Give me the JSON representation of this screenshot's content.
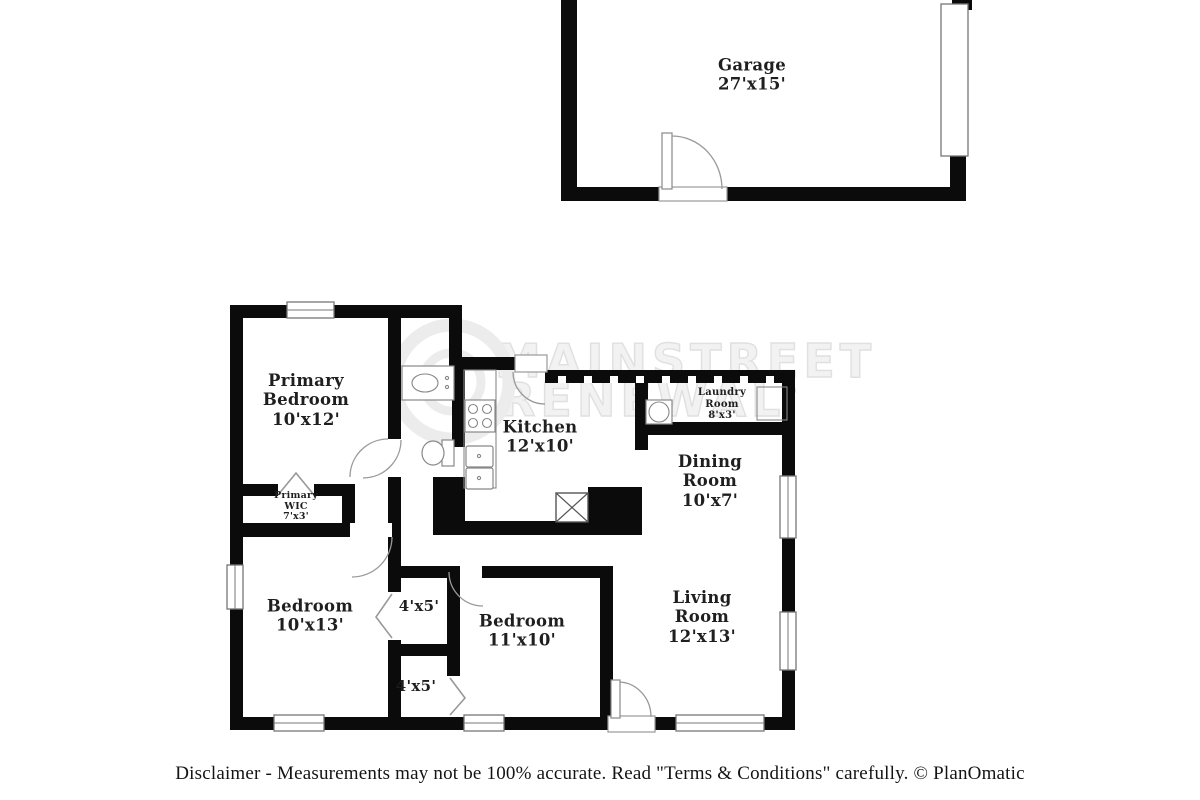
{
  "watermark": {
    "line1": "MAINSTREET",
    "line2": "RENEWAL",
    "tm": "™"
  },
  "rooms": {
    "garage": {
      "name": "Garage",
      "dims": "27'x15'"
    },
    "primary_bedroom": {
      "name": "Primary Bedroom",
      "dims": "10'x12'"
    },
    "primary_wic": {
      "name": "Primary WIC",
      "dims": "7'x3'"
    },
    "kitchen": {
      "name": "Kitchen",
      "dims": "12'x10'"
    },
    "laundry_room": {
      "name": "Laundry Room",
      "dims": "8'x3'"
    },
    "dining_room": {
      "name": "Dining Room",
      "dims": "10'x7'"
    },
    "bedroom_left": {
      "name": "Bedroom",
      "dims": "10'x13'"
    },
    "closet_top": {
      "dims": "4'x5'"
    },
    "closet_bottom": {
      "dims": "4'x5'"
    },
    "bedroom_middle": {
      "name": "Bedroom",
      "dims": "11'x10'"
    },
    "living_room": {
      "name": "Living Room",
      "dims": "12'x13'"
    }
  },
  "footer": {
    "disclaimer": "Disclaimer - Measurements may not be 100% accurate. Read \"Terms & Conditions\" carefully. © PlanOmatic"
  }
}
